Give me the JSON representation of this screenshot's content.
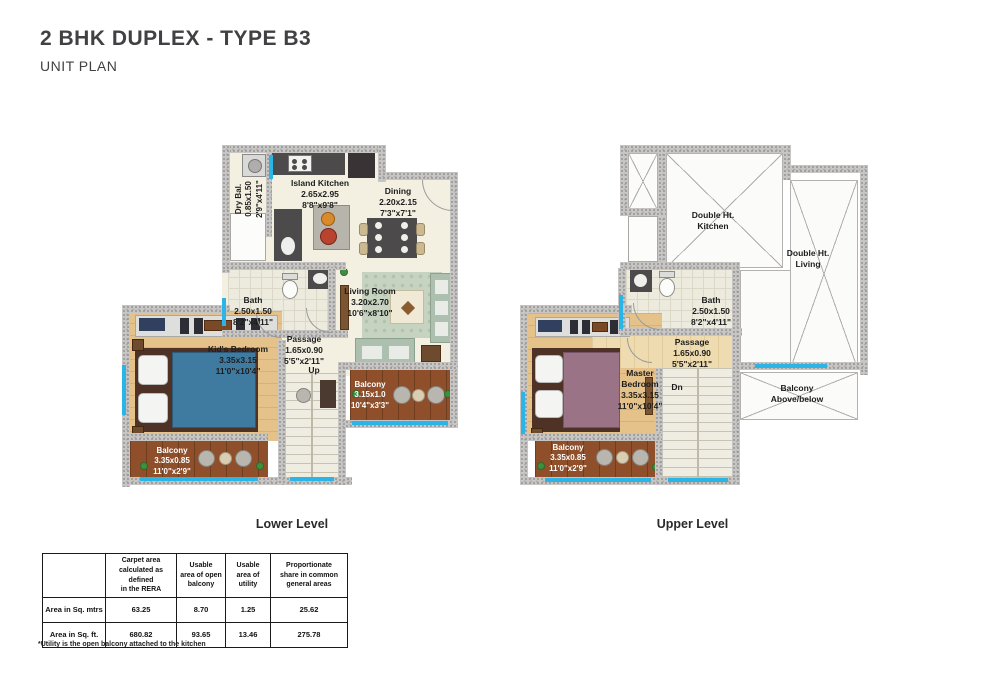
{
  "header": {
    "title": "2 BHK DUPLEX - TYPE B3",
    "subtitle": "UNIT PLAN"
  },
  "colors": {
    "window_accent": "#2ab5e6",
    "wall_gray": "#c7c6c4",
    "light_wood": "#e6c28b",
    "dark_wood": "#8e4f2a",
    "floor_cream": "#f3f0e2"
  },
  "levels": {
    "lower": {
      "caption": "Lower Level",
      "rooms": {
        "dry_bal": {
          "name": "Dry Bal.",
          "dims_m": "0.85x1.50",
          "dims_ft": "2'9\"x4'11\""
        },
        "island_kitchen": {
          "name": "Island Kitchen",
          "dims_m": "2.65x2.95",
          "dims_ft": "8'8\"x9'8\""
        },
        "dining": {
          "name": "Dining",
          "dims_m": "2.20x2.15",
          "dims_ft": "7'3\"x7'1\""
        },
        "bath": {
          "name": "Bath",
          "dims_m": "2.50x1.50",
          "dims_ft": "8'2\"x4'11\""
        },
        "living_room": {
          "name": "Living Room",
          "dims_m": "3.20x2.70",
          "dims_ft": "10'6\"x8'10\""
        },
        "passage": {
          "name": "Passage",
          "dims_m": "1.65x0.90",
          "dims_ft": "5'5\"x2'11\""
        },
        "stair_direction": "Up",
        "kids_bedroom": {
          "name": "Kid's Bedroom",
          "dims_m": "3.35x3.15",
          "dims_ft": "11'0\"x10'4\""
        },
        "balcony_right": {
          "name": "Balcony",
          "dims_m": "3.15x1.0",
          "dims_ft": "10'4\"x3'3\""
        },
        "balcony_bottom": {
          "name": "Balcony",
          "dims_m": "3.35x0.85",
          "dims_ft": "11'0\"x2'9\""
        }
      }
    },
    "upper": {
      "caption": "Upper Level",
      "rooms": {
        "double_ht_kitchen": {
          "name": "Double Ht.\nKitchen"
        },
        "double_ht_living": {
          "name": "Double Ht.\nLiving"
        },
        "bath": {
          "name": "Bath",
          "dims_m": "2.50x1.50",
          "dims_ft": "8'2\"x4'11\""
        },
        "passage": {
          "name": "Passage",
          "dims_m": "1.65x0.90",
          "dims_ft": "5'5\"x2'11\""
        },
        "master_bedroom": {
          "name": "Master\nBedroom",
          "dims_m": "3.35x3.15",
          "dims_ft": "11'0\"x10'4\""
        },
        "stair_direction": "Dn",
        "balcony_void": {
          "name": "Balcony\nAbove/below"
        },
        "balcony_bottom": {
          "name": "Balcony",
          "dims_m": "3.35x0.85",
          "dims_ft": "11'0\"x2'9\""
        }
      }
    }
  },
  "area_table": {
    "col_headers": [
      "",
      "Carpet area\ncalculated as\ndefined\nin the RERA",
      "Usable\narea of open\nbalcony",
      "Usable\narea of\nutility",
      "Proportionate\nshare in common\ngeneral areas"
    ],
    "rows": [
      {
        "label": "Area in Sq. mtrs",
        "values": [
          "63.25",
          "8.70",
          "1.25",
          "25.62"
        ]
      },
      {
        "label": "Area in Sq. ft.",
        "values": [
          "680.82",
          "93.65",
          "13.46",
          "275.78"
        ]
      }
    ]
  },
  "footnote": "*Utility is the open balcony attached to the kitchen"
}
